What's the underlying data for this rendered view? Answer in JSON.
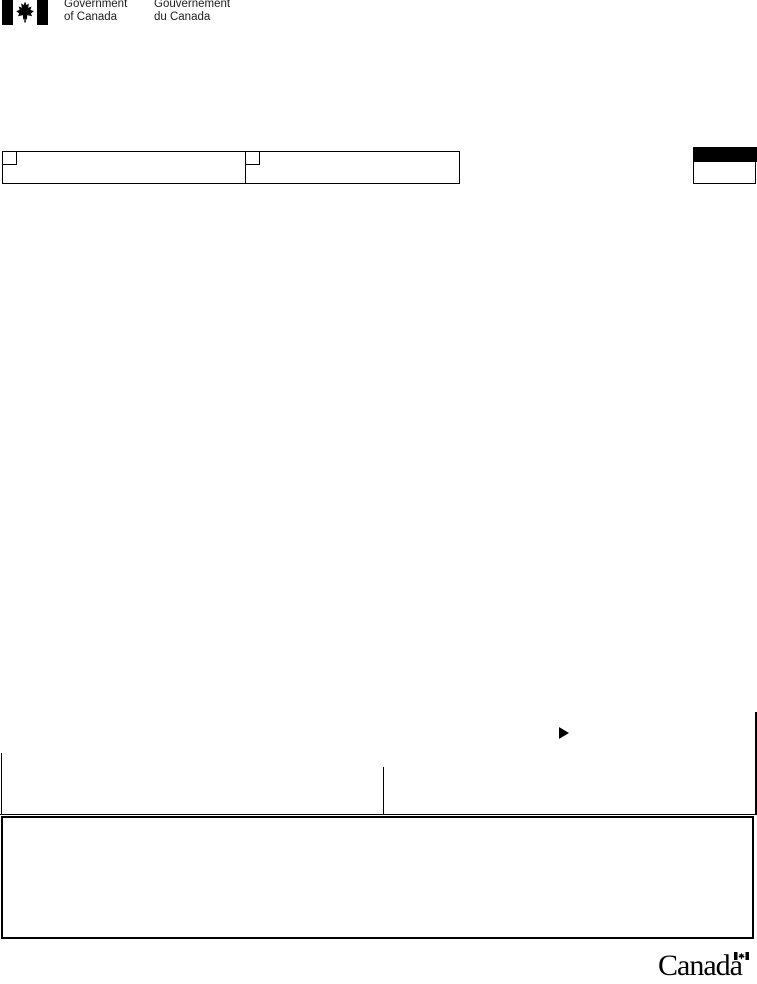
{
  "colors": {
    "ink": "#000000",
    "paper": "#ffffff",
    "classification_bar": "#000000"
  },
  "icons": {
    "header_flag": "canada-flag-icon",
    "pointer": "right-pointer-icon",
    "wordmark_flag": "canada-wordmark-flag-icon"
  },
  "fip_header": {
    "english_line1": "Government",
    "english_line2": "of Canada",
    "french_line1": "Gouvernement",
    "french_line2": "du Canada"
  },
  "checkbox_row": {
    "left_checkbox_checked": false,
    "right_checkbox_checked": false
  },
  "footer": {
    "wordmark_text": "Canada"
  }
}
